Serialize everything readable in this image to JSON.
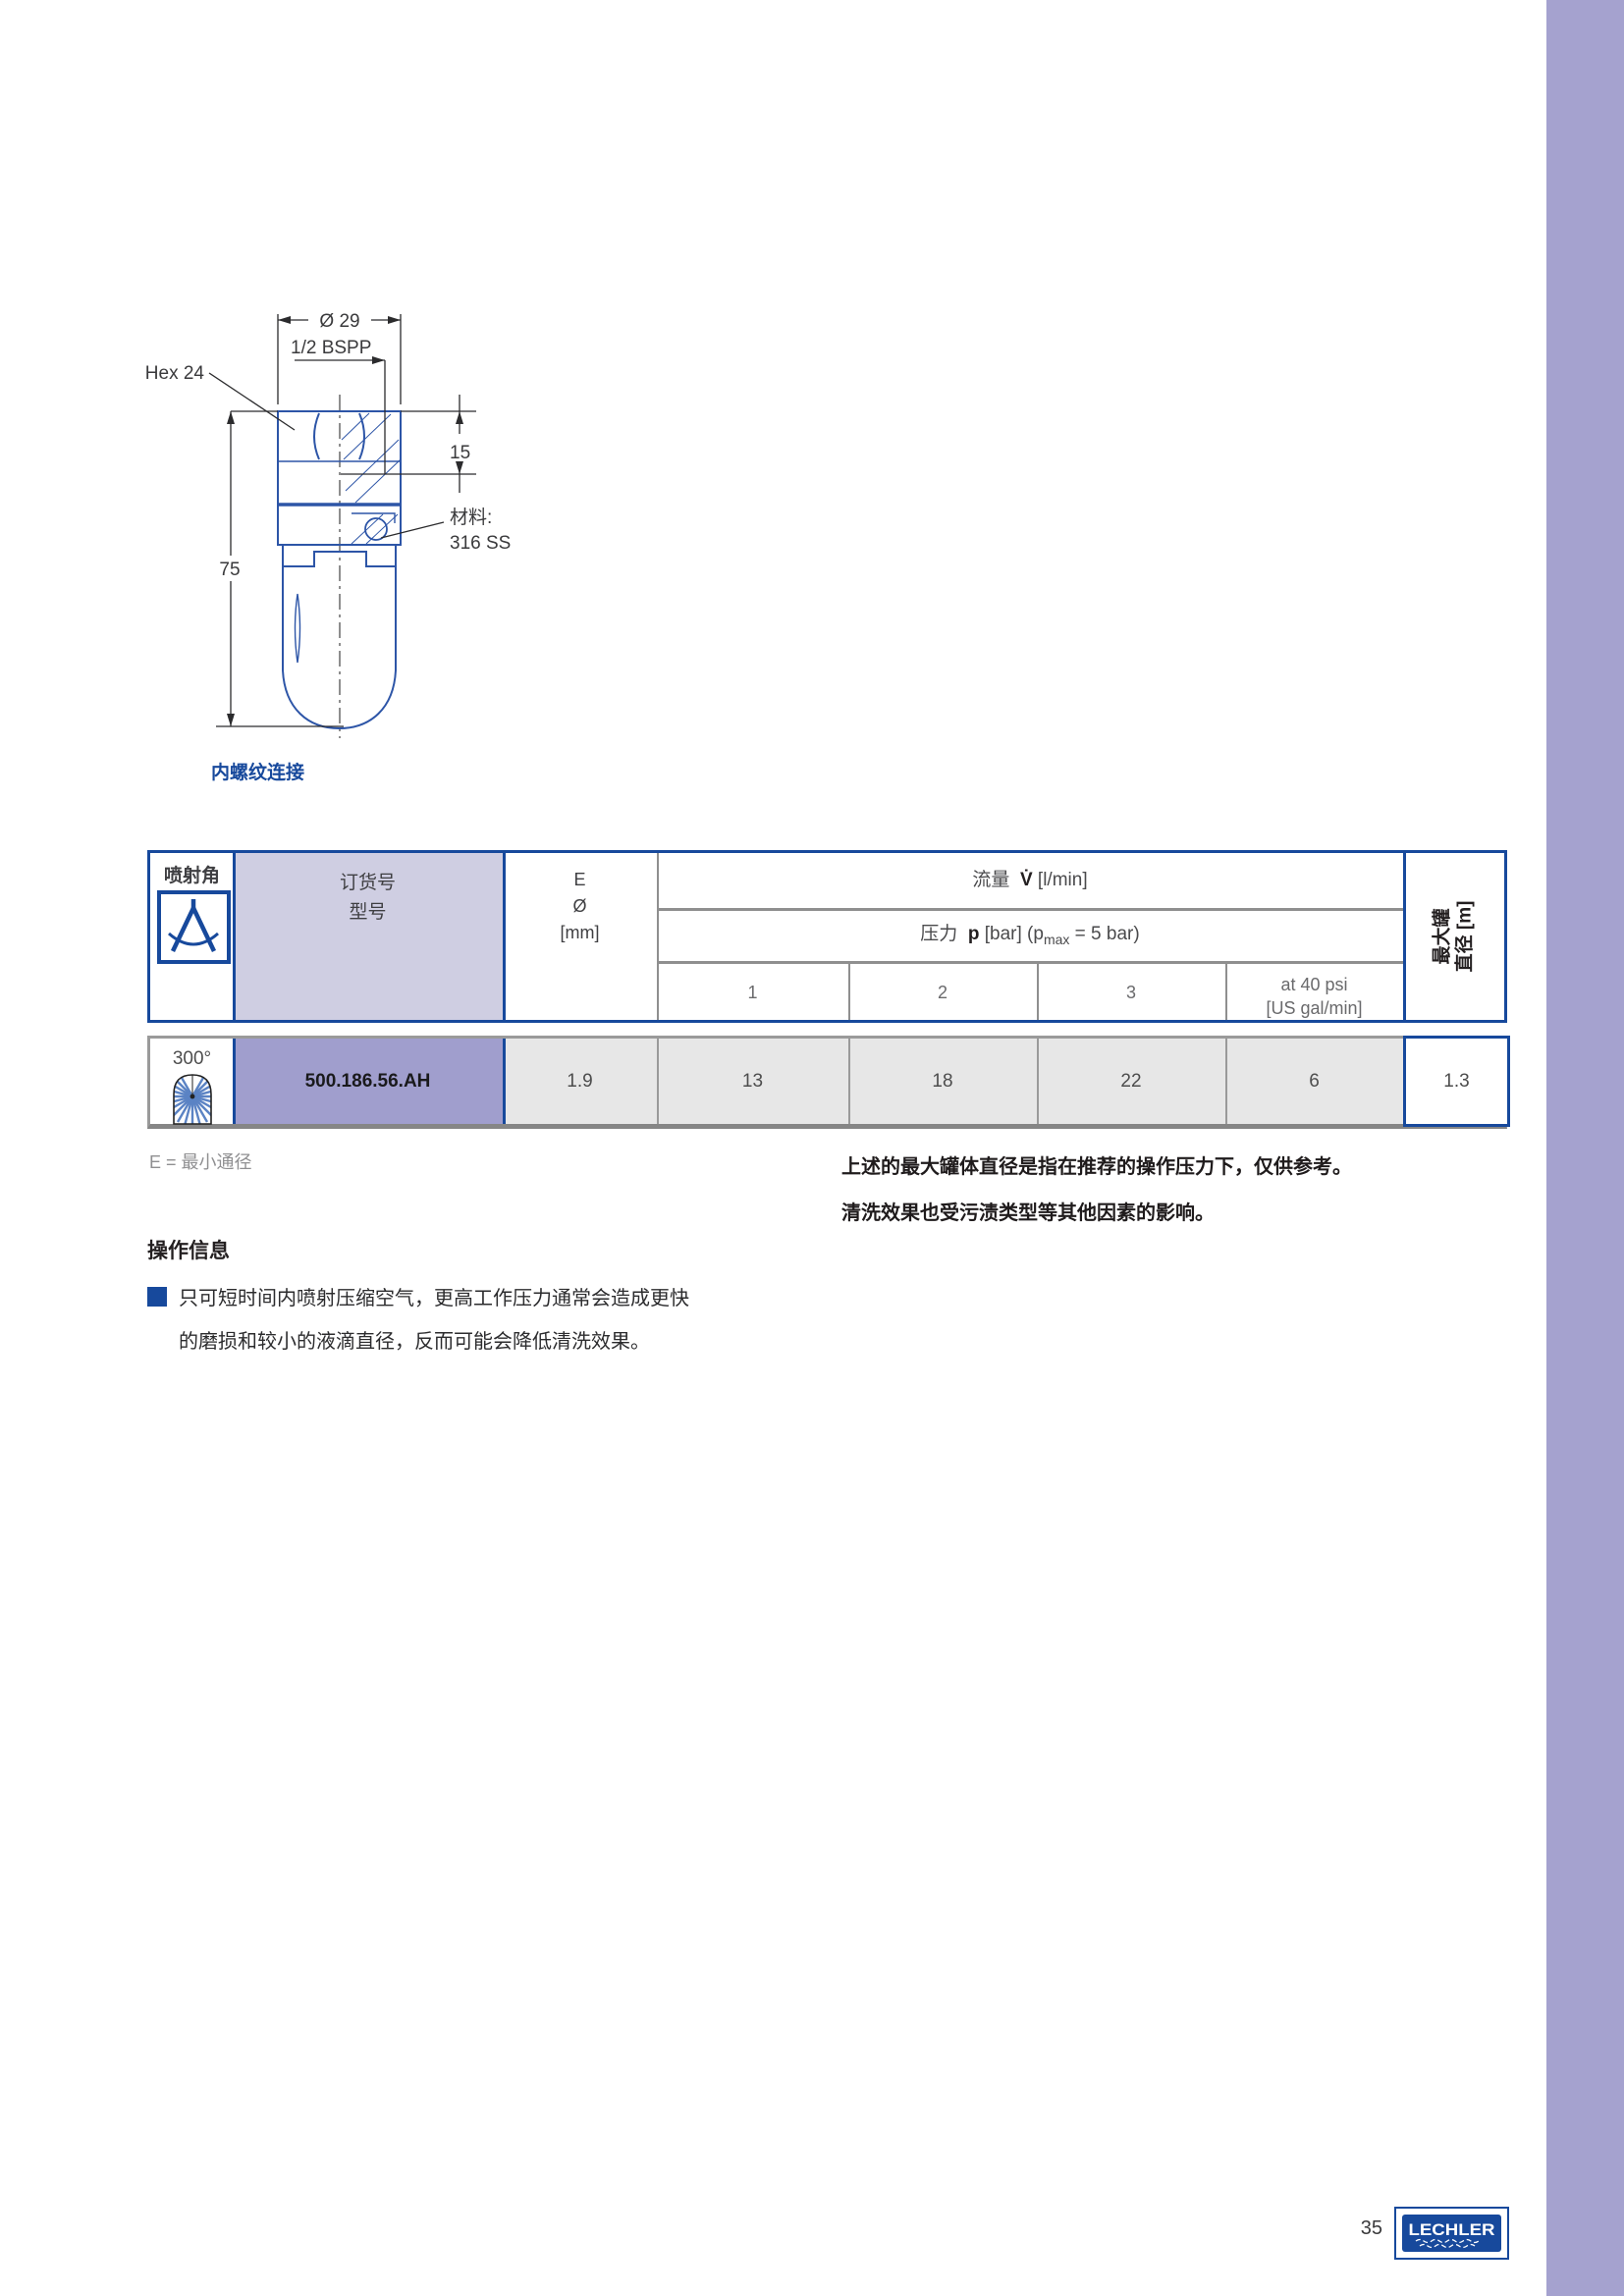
{
  "page": {
    "number": "35",
    "brand": "LECHLER"
  },
  "colors": {
    "brand_blue": "#17499c",
    "drawing_blue": "#2d55a7",
    "side_band": "#a5a2cf",
    "header_lavender": "#cfcee2",
    "row_purple": "#a09ecd",
    "row_gray": "#e7e7e7"
  },
  "drawing": {
    "dims": {
      "diameter": "Ø 29",
      "thread": "1/2 BSPP",
      "hex": "Hex 24",
      "depth": "15",
      "height": "75"
    },
    "material_label": "材料:",
    "material_value": "316 SS",
    "caption": "内螺纹连接"
  },
  "table": {
    "headers": {
      "spray_angle": "喷射角",
      "order_no": "订货号",
      "type": "型号",
      "e_line1": "E",
      "e_line2": "Ø",
      "e_line3": "[mm]",
      "flow_label": "流量",
      "flow_symbol": "V̇",
      "flow_unit": "[l/min]",
      "pressure_label": "压力",
      "pressure_symbol": "p",
      "pressure_bracket": "[bar] (p",
      "pressure_sub": "max",
      "pressure_suffix": " = 5 bar)",
      "col1": "1",
      "col2": "2",
      "col3": "3",
      "psi_line1": "at 40 psi",
      "psi_line2": "[US gal/min]",
      "tank_line1": "最大罐",
      "tank_line2": "直径 [m]"
    },
    "row": {
      "angle": "300°",
      "order_no": "500.186.56.AH",
      "e_mm": "1.9",
      "flow_1bar": "13",
      "flow_2bar": "18",
      "flow_3bar": "22",
      "flow_40psi": "6",
      "tank_diameter": "1.3"
    }
  },
  "notes": {
    "e_note": "E = 最小通径",
    "right_note_line1": "上述的最大罐体直径是指在推荐的操作压力下，仅供参考。",
    "right_note_line2": "清洗效果也受污渍类型等其他因素的影响。",
    "operation_title": "操作信息",
    "operation_line1": "只可短时间内喷射压缩空气，更高工作压力通常会造成更快",
    "operation_line2": "的磨损和较小的液滴直径，反而可能会降低清洗效果。"
  }
}
